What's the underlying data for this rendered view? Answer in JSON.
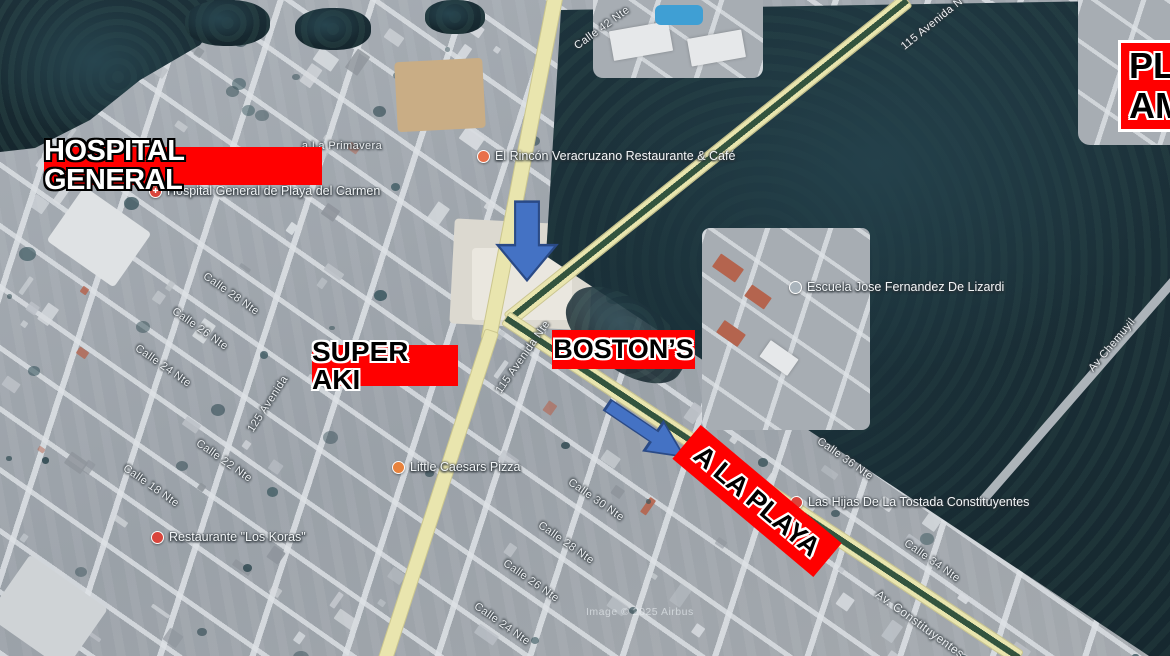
{
  "banners": {
    "hospital": "HOSPITAL GENERAL",
    "super_aki": "SUPER AKI",
    "bostons": "BOSTON’S",
    "a_la_playa": "A LA PLAYA",
    "plaza_line1": "PLA",
    "plaza_line2": "AM"
  },
  "colors": {
    "banner_red": "#ff0000",
    "arrow_fill": "#4472c4",
    "arrow_stroke": "#2a4a86"
  },
  "pois": [
    {
      "icon": "hospital-icon",
      "color": "#d9453c",
      "text": "Hospital General de Playa del Carmen",
      "x": 149,
      "y": 184
    },
    {
      "icon": "restaurant-icon",
      "color": "#e8704a",
      "text": "El Rincón Veracruzano Restaurante & Café",
      "x": 477,
      "y": 149
    },
    {
      "icon": "school-icon",
      "color": "#aab4bc",
      "text": "Escuela Jose Fernandez De Lizardi",
      "x": 789,
      "y": 280
    },
    {
      "icon": "restaurant-icon",
      "color": "#e8823c",
      "text": "Little Caesars Pizza",
      "x": 392,
      "y": 460
    },
    {
      "icon": "restaurant-icon",
      "color": "#d9453c",
      "text": "Restaurante \"Los Koras\"",
      "x": 151,
      "y": 530
    },
    {
      "icon": "restaurant-icon",
      "color": "#d9453c",
      "text": "Las Hijas De La Tostada Constituyentes",
      "x": 790,
      "y": 495
    }
  ],
  "streets": [
    {
      "text": "115 Avenida Nte",
      "x": 523,
      "y": 357,
      "rot": -55
    },
    {
      "text": "115 Avenida N",
      "x": 932,
      "y": 24,
      "rot": -39
    },
    {
      "text": "Calle 42 Nte",
      "x": 602,
      "y": 28,
      "rot": -36
    },
    {
      "text": "Av Chemuyil",
      "x": 1112,
      "y": 345,
      "rot": -50
    },
    {
      "text": "Calle 36 Nte",
      "x": 845,
      "y": 459,
      "rot": 35
    },
    {
      "text": "Calle 34 Nte",
      "x": 932,
      "y": 561,
      "rot": 35
    },
    {
      "text": "Av. Constituyentes",
      "x": 920,
      "y": 624,
      "rot": 36
    },
    {
      "text": "Calle 30 Nte",
      "x": 596,
      "y": 500,
      "rot": 35
    },
    {
      "text": "Calle 28 Nte",
      "x": 566,
      "y": 543,
      "rot": 35
    },
    {
      "text": "Calle 26 Nte",
      "x": 531,
      "y": 581,
      "rot": 35
    },
    {
      "text": "Calle 24 Nte",
      "x": 502,
      "y": 624,
      "rot": 35
    },
    {
      "text": "Calle 28 Nte",
      "x": 231,
      "y": 294,
      "rot": 35
    },
    {
      "text": "Calle 26 Nte",
      "x": 200,
      "y": 329,
      "rot": 35
    },
    {
      "text": "Calle 24 Nte",
      "x": 163,
      "y": 366,
      "rot": 35
    },
    {
      "text": "125 Avenida",
      "x": 268,
      "y": 404,
      "rot": -57
    },
    {
      "text": "Calle 22 Nte",
      "x": 224,
      "y": 461,
      "rot": 35
    },
    {
      "text": "Calle 18 Nte",
      "x": 151,
      "y": 486,
      "rot": 35
    },
    {
      "text": "a La Primavera",
      "x": 342,
      "y": 146,
      "rot": 0
    }
  ],
  "watermark": "Image © 2025 Airbus"
}
